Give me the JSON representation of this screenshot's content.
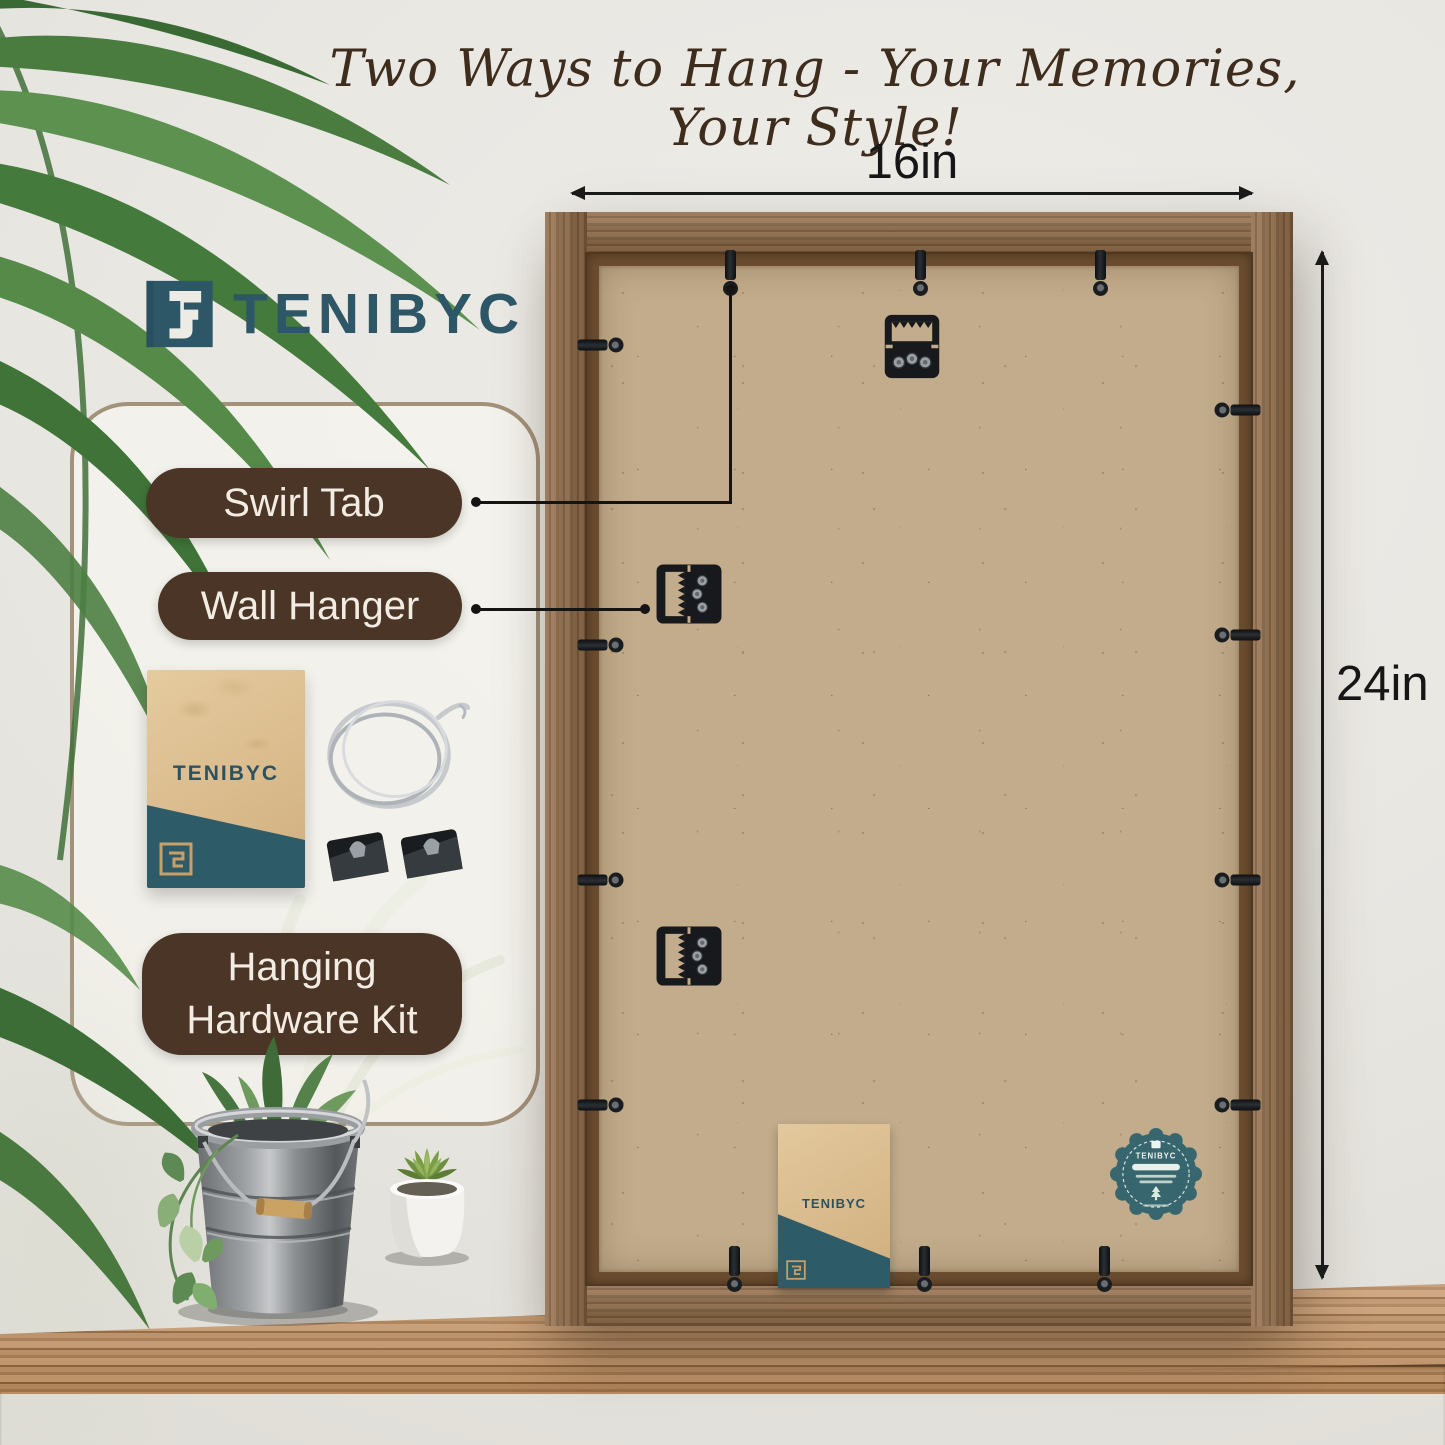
{
  "heading": {
    "script_text": "Two Ways to Hang - Your Memories, Your Style!"
  },
  "brand": {
    "name": "TENIBYC"
  },
  "callouts": {
    "swirl_tab": "Swirl Tab",
    "wall_hanger": "Wall Hanger",
    "hardware_kit": {
      "line1": "Hanging",
      "line2": "Hardware Kit"
    }
  },
  "dimensions": {
    "width": "16in",
    "height": "24in"
  },
  "kit_envelope": {
    "brand": "TENIBYC"
  },
  "frame_back": {
    "envelope_brand": "TENIBYC",
    "badge_brand": "TENIBYC"
  },
  "icons": {
    "brand-logo-icon": "teal stencil square monogram",
    "swirl-tab-icon": "black metal swivel tab with screw",
    "sawtooth-hanger-icon": "black sawtooth wall hanger plate",
    "wire-coil-icon": "coiled steel hanging wire",
    "corner-clip-icon": "pair of black hanging clips",
    "certification-badge-icon": "teal scalloped compliance sticker",
    "palm-leaves-icon": "green palm fronds",
    "plant-bucket-icon": "galvanized bucket with trailing plant",
    "succulent-pot-icon": "white pot with succulent"
  },
  "colors": {
    "wall": "#e9e7e2",
    "accent_brown": "#4a3527",
    "brand_teal": "#2d5766",
    "envelope_teal": "#2e5b68",
    "badge_teal": "#38666f",
    "frame_wood": "#8a6646",
    "backing_kraft": "#c2ac8b",
    "dimension_text": "#161616"
  }
}
